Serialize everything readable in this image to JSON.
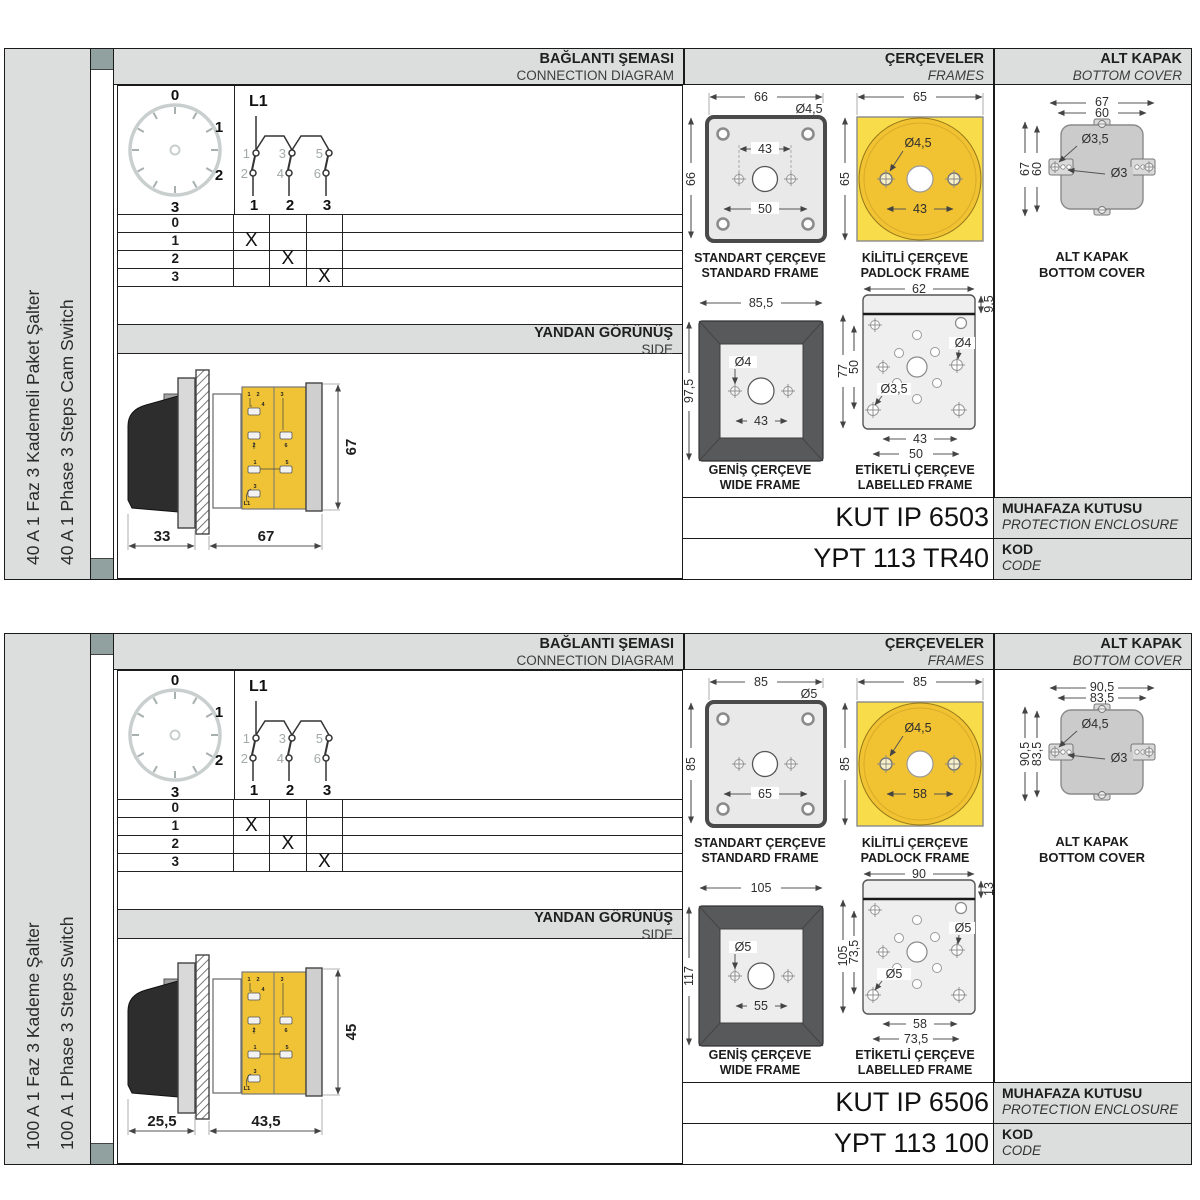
{
  "blocks": [
    {
      "side_title_tr": "40 A 1 Faz 3 Kademeli Paket Şalter",
      "side_title_en": "40 A 1 Phase 3 Steps Cam Switch",
      "sections": {
        "connection_tr": "BAĞLANTI ŞEMASI",
        "connection_en": "CONNECTION DIAGRAM",
        "frames_tr": "ÇERÇEVELER",
        "frames_en": "FRAMES",
        "cover_tr": "ALT KAPAK",
        "cover_en": "BOTTOM COVER"
      },
      "dial": {
        "positions": [
          "0",
          "1",
          "2",
          "3"
        ]
      },
      "circuit": {
        "phase": "L1",
        "upper": [
          "1",
          "3",
          "5"
        ],
        "lower": [
          "2",
          "4",
          "6"
        ],
        "terminals": [
          "1",
          "2",
          "3"
        ]
      },
      "table": {
        "rows": [
          "0",
          "1",
          "2",
          "3"
        ],
        "marks": [
          [
            "",
            "",
            ""
          ],
          [
            "X",
            "",
            ""
          ],
          [
            "",
            "X",
            ""
          ],
          [
            "",
            "",
            "X"
          ]
        ]
      },
      "side_view": {
        "tr": "YANDAN GÖRÜNÜŞ",
        "en": "SIDE",
        "dim_handle": "33",
        "dim_body": "67",
        "dim_height": "67",
        "labels": [
          "1",
          "2",
          "4",
          "2",
          "3",
          "6",
          "1",
          "3",
          "5",
          "L1"
        ]
      },
      "standard_frame": {
        "tr": "STANDART ÇERÇEVE",
        "en": "STANDARD FRAME",
        "dim_w": "66",
        "dim_h": "66",
        "hole": "Ø4,5",
        "dim_inner": "43",
        "dim_bottom": "50"
      },
      "padlock_frame": {
        "tr": "KİLİTLİ ÇERÇEVE",
        "en": "PADLOCK FRAME",
        "dim_w": "65",
        "dim_h": "65",
        "hole": "Ø4,5",
        "dim_inner": "43"
      },
      "wide_frame": {
        "tr": "GENİŞ ÇERÇEVE",
        "en": "WIDE FRAME",
        "dim_w": "85,5",
        "dim_h": "97,5",
        "hole": "Ø4",
        "dim_inner": "43"
      },
      "labelled_frame": {
        "tr": "ETİKETLİ ÇERÇEVE",
        "en": "LABELLED FRAME",
        "dim_w": "62",
        "dim_strip": "9,5",
        "dim_h": "77",
        "dim_inner_h": "50",
        "hole_big": "Ø4",
        "hole_small": "Ø3,5",
        "dim_b1": "43",
        "dim_b2": "50"
      },
      "bottom_cover": {
        "tr": "ALT KAPAK",
        "en": "BOTTOM COVER",
        "dim_w1": "67",
        "dim_w2": "60",
        "dim_h1": "67",
        "dim_h2": "60",
        "hole1": "Ø3,5",
        "hole2": "Ø3"
      },
      "enclosure": {
        "value": "KUT IP 6503",
        "tr": "MUHAFAZA KUTUSU",
        "en": "PROTECTION ENCLOSURE"
      },
      "code": {
        "value": "YPT 113 TR40",
        "tr": "KOD",
        "en": "CODE"
      }
    },
    {
      "side_title_tr": "100 A 1 Faz 3 Kademe Şalter",
      "side_title_en": "100 A 1 Phase 3 Steps Switch",
      "sections": {
        "connection_tr": "BAĞLANTI ŞEMASI",
        "connection_en": "CONNECTION DIAGRAM",
        "frames_tr": "ÇERÇEVELER",
        "frames_en": "FRAMES",
        "cover_tr": "ALT KAPAK",
        "cover_en": "BOTTOM COVER"
      },
      "dial": {
        "positions": [
          "0",
          "1",
          "2",
          "3"
        ]
      },
      "circuit": {
        "phase": "L1",
        "upper": [
          "1",
          "3",
          "5"
        ],
        "lower": [
          "2",
          "4",
          "6"
        ],
        "terminals": [
          "1",
          "2",
          "3"
        ]
      },
      "table": {
        "rows": [
          "0",
          "1",
          "2",
          "3"
        ],
        "marks": [
          [
            "",
            "",
            ""
          ],
          [
            "X",
            "",
            ""
          ],
          [
            "",
            "X",
            ""
          ],
          [
            "",
            "",
            "X"
          ]
        ]
      },
      "side_view": {
        "tr": "YANDAN GÖRÜNÜŞ",
        "en": "SIDE",
        "dim_handle": "25,5",
        "dim_body": "43,5",
        "dim_height": "45",
        "labels": [
          "1",
          "2",
          "4",
          "2",
          "3",
          "6",
          "1",
          "3",
          "5",
          "L1"
        ]
      },
      "standard_frame": {
        "tr": "STANDART ÇERÇEVE",
        "en": "STANDARD FRAME",
        "dim_w": "85",
        "dim_h": "85",
        "hole": "Ø5",
        "dim_inner": "",
        "dim_bottom": "65"
      },
      "padlock_frame": {
        "tr": "KİLİTLİ ÇERÇEVE",
        "en": "PADLOCK FRAME",
        "dim_w": "85",
        "dim_h": "85",
        "hole": "Ø4,5",
        "dim_inner": "58"
      },
      "wide_frame": {
        "tr": "GENİŞ ÇERÇEVE",
        "en": "WIDE FRAME",
        "dim_w": "105",
        "dim_h": "117",
        "hole": "Ø5",
        "dim_inner": "55"
      },
      "labelled_frame": {
        "tr": "ETİKETLİ ÇERÇEVE",
        "en": "LABELLED FRAME",
        "dim_w": "90",
        "dim_strip": "13",
        "dim_h": "105",
        "dim_inner_h": "73,5",
        "hole_big": "Ø5",
        "hole_small": "Ø5",
        "dim_b1": "58",
        "dim_b2": "73,5"
      },
      "bottom_cover": {
        "tr": "ALT KAPAK",
        "en": "BOTTOM COVER",
        "dim_w1": "90,5",
        "dim_w2": "83,5",
        "dim_h1": "90,5",
        "dim_h2": "83,5",
        "hole1": "Ø4,5",
        "hole2": "Ø3"
      },
      "enclosure": {
        "value": "KUT IP 6506",
        "tr": "MUHAFAZA KUTUSU",
        "en": "PROTECTION ENCLOSURE"
      },
      "code": {
        "value": "YPT 113 100",
        "tr": "KOD",
        "en": "CODE"
      }
    }
  ]
}
